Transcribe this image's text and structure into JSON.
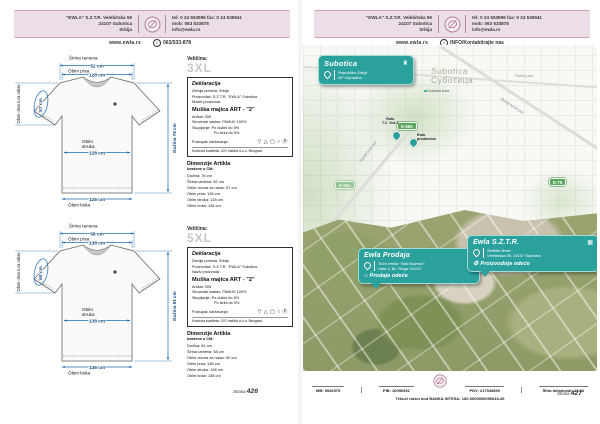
{
  "colors": {
    "teal": "#2ba19d",
    "dim_blue": "#1b6cb5",
    "header_pink": "#ecdee6",
    "road_green": "#58a75a"
  },
  "icons": {
    "building_glyph": "▦",
    "shop_glyph": "⌂",
    "factory_glyph": "⚙",
    "tower_glyph": "♜",
    "info_glyph": "i"
  },
  "header": {
    "address_lines": [
      "\"EWLA\" S.Z.T.R.  Velebitska 59",
      "24107 Subotica",
      "Srbija"
    ],
    "contact_lines": [
      "tel: 0 24 553999  fax: 0 24 539941",
      "mob: 063 533878",
      "info@ewla.rs"
    ],
    "website": "www.ewla.rs",
    "left_tagline": "063/533-878",
    "right_tagline": "INFO/Kontaktirajte nas"
  },
  "left_page": {
    "page_label": "Strana",
    "page_number": "426",
    "shirts": [
      {
        "size_label": "Veličina:",
        "size": "3XL",
        "declaration": {
          "title": "Deklaracija",
          "line1": "Zemlja porekla: Srbija",
          "line2": "Proizvođač: S.Z.T.R. \"EWLA\" Subotica",
          "line3": "Model proizvoda:",
          "product_name": "Muška majica ART - \"2\"",
          "line4": "Artikal: 005",
          "line5": "Sirovinski sastav: PAMUK 100%",
          "line6": "Skupljanje: Po dužini do 5%",
          "line7": "Po širini do 5%",
          "care_label": "Postupak održavanja:",
          "care_symbols": "▽ △ ▢ ○ Ⓟ",
          "quality_line": "Kontrola kvaliteta: CIS Institut d.o.o. Beograd"
        },
        "dims": {
          "title": "Dimenzije Artikla",
          "subtitle": "Izražene u CM:",
          "rows": [
            "Dužina: 78 cm",
            "Širina ramena: 52 cm",
            "Obim otvora za rukav: 57 cm",
            "Obim prsa: 128 cm",
            "Obim struka: 128 cm",
            "Obim boka: 128 cm"
          ]
        },
        "diagram": {
          "shoulder_label": "Širina ramena",
          "shoulder_value": "52 cm",
          "chest_label": "Obim prsa",
          "chest_value": "128 cm",
          "sleeve_label": "Obim otvora za rukav",
          "sleeve_value": "57 cm",
          "waist_label_1": "Obim",
          "waist_label_2": "struka",
          "waist_value": "128 cm",
          "length_label": "Dužina 78 cm",
          "hip_value": "128 cm",
          "hip_label": "Obim boka"
        }
      },
      {
        "size_label": "Veličina:",
        "size": "5XL",
        "declaration": {
          "title": "Deklaracija",
          "line1": "Zemlja porekla: Srbija",
          "line2": "Proizvođač: S.Z.T.R. \"EWLA\" Subotica",
          "line3": "Naziv proizvoda:",
          "product_name": "Muška majica ART - \"2\"",
          "line4": "Artikal: 005",
          "line5": "Sirovinski sastav: PAMUK 100%",
          "line6": "Skupljanje: Po dužini do 5%",
          "line7": "Po širini do 5%",
          "care_label": "Postupak održavanja:",
          "care_symbols": "▽ △ ▢ ○ Ⓟ",
          "quality_line": "Kontrola kvaliteta: CIS Institut d.o.o. Beograd"
        },
        "dims": {
          "title": "Dimenzije Artikla",
          "subtitle": "Izražene u CM:",
          "rows": [
            "Dužina: 81 cm",
            "Širina ramena: 58 cm",
            "Obim otvora za rukav: 60 cm",
            "Obim prsa: 138 cm",
            "Obim struka: 138 cm",
            "Obim boka: 138 cm"
          ]
        },
        "diagram": {
          "shoulder_label": "Širina ramena",
          "shoulder_value": "58 cm",
          "chest_label": "Obim prsa",
          "chest_value": "138 cm",
          "sleeve_label": "Obim otvora za rukav",
          "sleeve_value": "60 cm",
          "waist_label_1": "Obim",
          "waist_label_2": "struka",
          "waist_value": "138 cm",
          "length_label": "Dužina 81 cm",
          "hip_value": "138 cm",
          "hip_label": "Obim boka"
        }
      }
    ]
  },
  "right_page": {
    "page_label": "Strana",
    "page_number": "427",
    "region_box": {
      "title": "Subotica",
      "line1": "Republika Srbija",
      "line2": "AP Vojvodina"
    },
    "map": {
      "city_latin": "Subotica",
      "city_cyrillic": "Суботица",
      "poi": "Gradska kuća",
      "street1": "Palićki put",
      "street2": "Somborski put",
      "street3": "Beogradski put",
      "badge1": "E-662",
      "badge2": "E-662",
      "badge3": "E-75",
      "pin1_label1": "Ewla",
      "pin1_label2": "T.C. Vuk 2",
      "pin2_label1": "Ewla",
      "pin2_label2": "prodavnica"
    },
    "callout_shop": {
      "title": "Ewla Prodaja",
      "line1": "Tržni centar \"Mali Bajmok\"",
      "line2": "Hala 3, Bc Tezga 311/23",
      "footer": "Prodaja odeće"
    },
    "callout_hq": {
      "title": "Ewla S.Z.T.R.",
      "line1": "Sedište firme:",
      "line2": "Velebitska 59, 24107 Subotica",
      "footer": "Proizvodnja odeće"
    },
    "footer": {
      "item1": "MB: 5546979",
      "item2": "PIB: 10096351",
      "item3": "PDV: 217549890",
      "item4": "Šifra delatnosti: 14.13",
      "bank_line": "Tekući račun kod BANKA INTESA: 160-0000000096643-46"
    }
  }
}
